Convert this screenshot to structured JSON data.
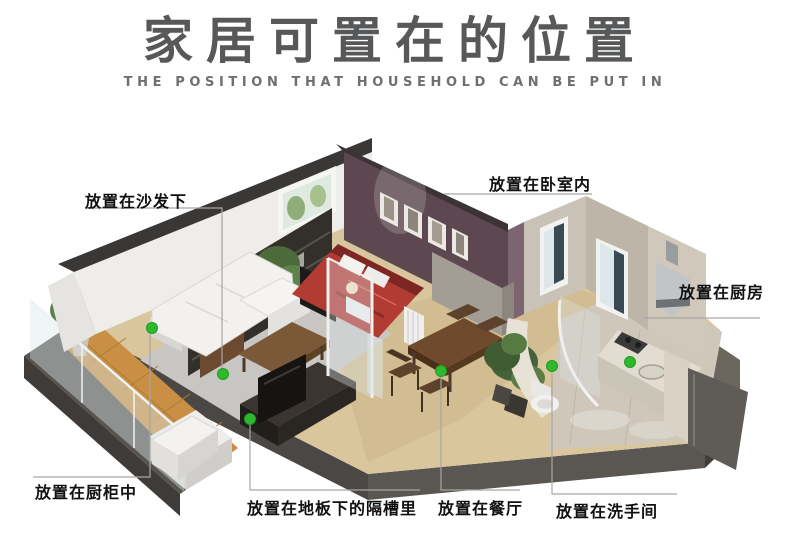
{
  "header": {
    "title": "家居可置在的位置",
    "subtitle": "THE POSITION THAT HOUSEHOLD CAN BE PUT IN"
  },
  "callouts": {
    "sofa": "放置在沙发下",
    "bedroom": "放置在卧室内",
    "kitchen": "放置在厨房",
    "cupboard": "放置在厨柜中",
    "floor_slot": "放置在地板下的隔槽里",
    "dining": "放置在餐厅",
    "bathroom": "放置在洗手间"
  },
  "markers": {
    "shape": "green-dot",
    "color": "#2eb82e",
    "count": 6,
    "locations": [
      "under-sofa",
      "in-cupboard",
      "floor-slot",
      "dining-table",
      "bathroom",
      "kitchen"
    ]
  },
  "colors": {
    "title_text": "#57585a",
    "subtitle_text": "#6e6f71",
    "callout_text": "#101010",
    "leader_line": "#a6a6a6",
    "marker_green": "#2eb82e",
    "bedroom_wall": "#5d4750",
    "balcony_floor": "#c98f45",
    "bed_red": "#b23b34",
    "base_slab": "#4a4744",
    "background": "#ffffff"
  }
}
